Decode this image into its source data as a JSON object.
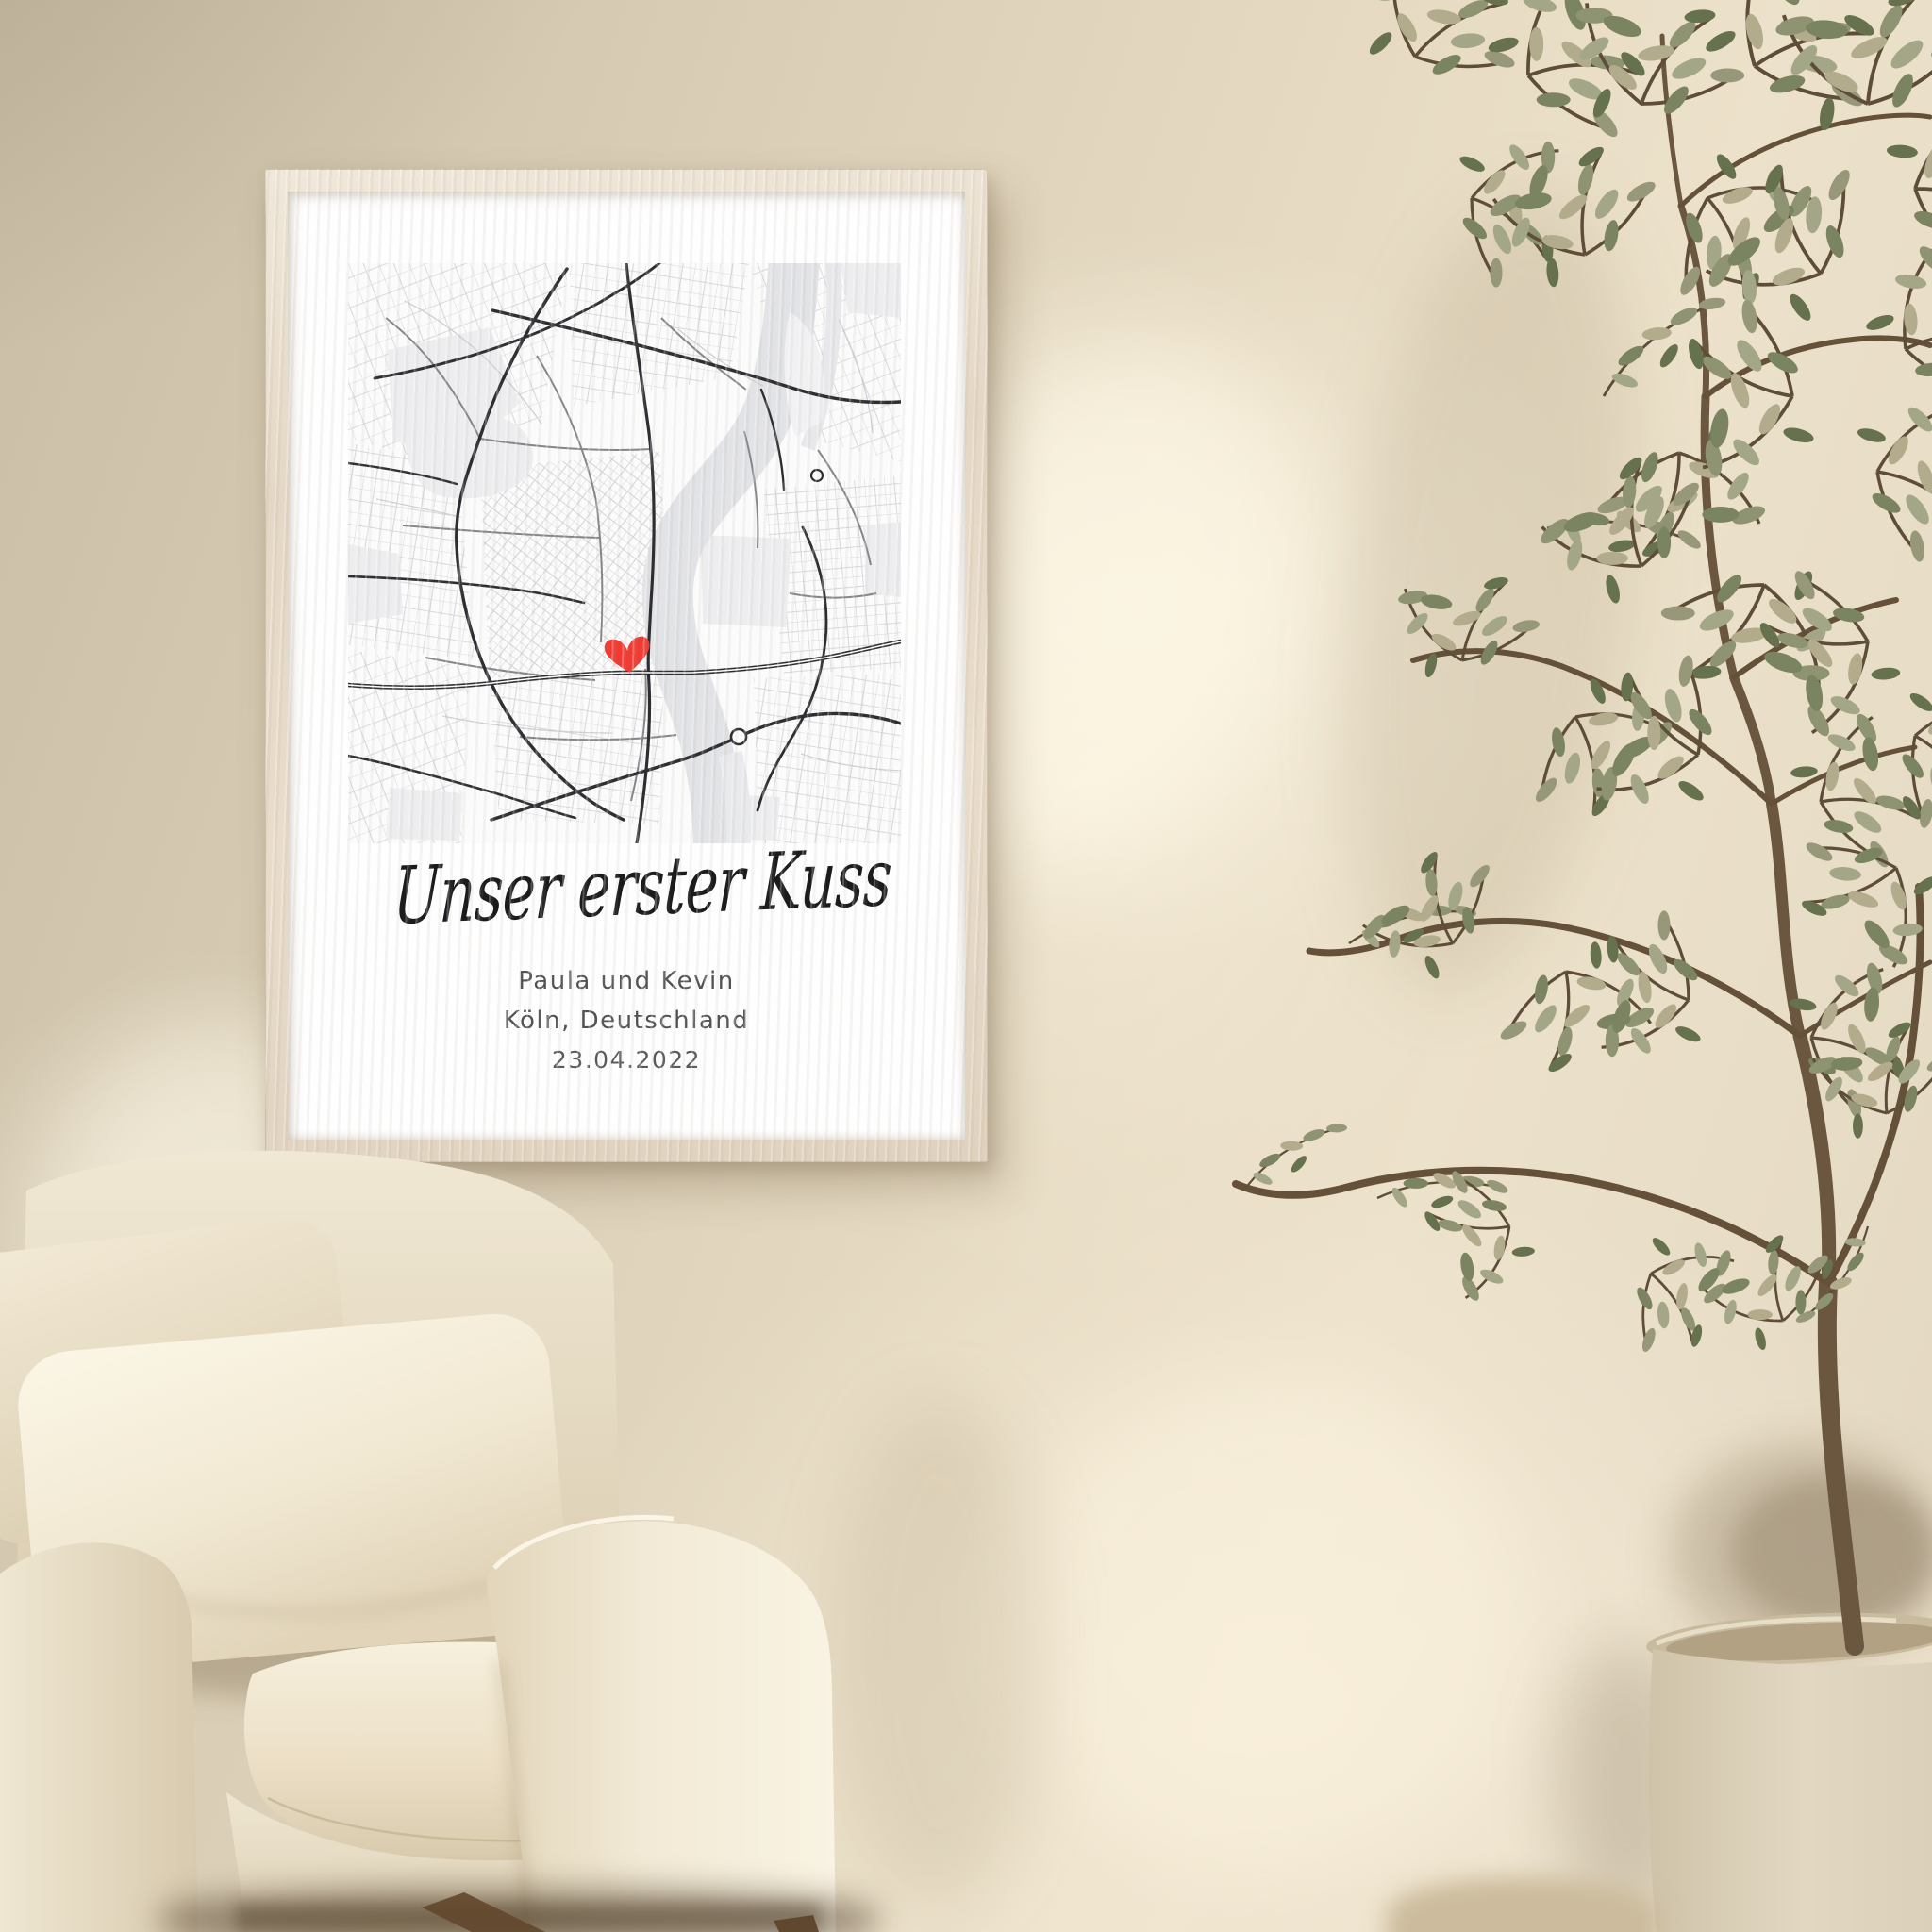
{
  "poster": {
    "title": "Unser erster Kuss",
    "names": "Paula und Kevin",
    "location": "Köln, Deutschland",
    "date": "23.04.2022",
    "marker": {
      "icon": "heart-icon",
      "color": "#ef3b33"
    },
    "map_colors": {
      "background": "#fbfbfc",
      "river": "#e2e3e7",
      "parks": "#ededf0",
      "road_dark": "#2e2e32",
      "road_mid": "#85858a",
      "road_light": "#d6d6da"
    }
  },
  "scene": {
    "wall_color": "#ddd1ba",
    "frame_wood_color": "#e8dccb",
    "paper_color": "#fefefe",
    "armchair_color": "#f2ebd8",
    "pillow_color": "#f8f2e2",
    "wood_leg_color": "#7a5b3b",
    "plant_leaf_color": "#8c9070",
    "plant_trunk_color": "#6b5740",
    "plant_pot_color": "#ddd3bd"
  }
}
